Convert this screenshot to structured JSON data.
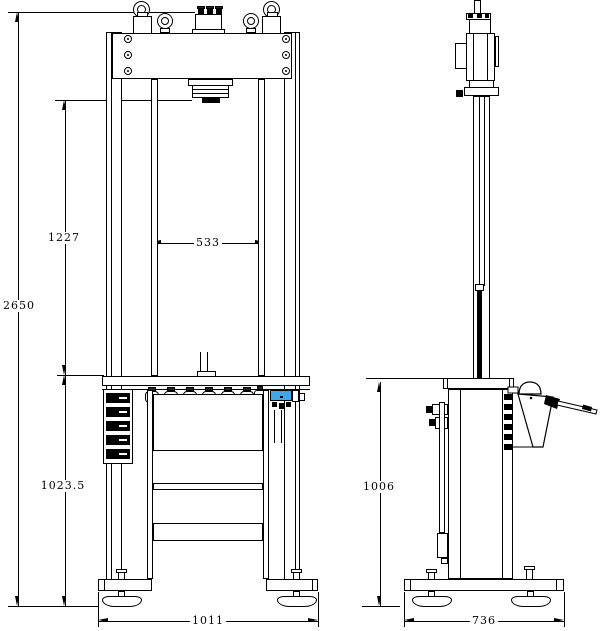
{
  "colors": {
    "line": "#000000",
    "background": "#ffffff",
    "highlight_blue": "#3fa7e8"
  },
  "dimensions": {
    "front": [
      {
        "name": "overall-height",
        "value": "2650",
        "orientation": "vertical"
      },
      {
        "name": "ram-to-table",
        "value": "1227",
        "orientation": "vertical"
      },
      {
        "name": "clear-width",
        "value": "533",
        "orientation": "horizontal"
      },
      {
        "name": "table-to-floor",
        "value": "1023.5",
        "orientation": "vertical"
      },
      {
        "name": "base-width",
        "value": "1011",
        "orientation": "horizontal"
      }
    ],
    "side": [
      {
        "name": "table-height",
        "value": "1006",
        "orientation": "vertical"
      },
      {
        "name": "base-depth",
        "value": "736",
        "orientation": "horizontal"
      }
    ]
  }
}
